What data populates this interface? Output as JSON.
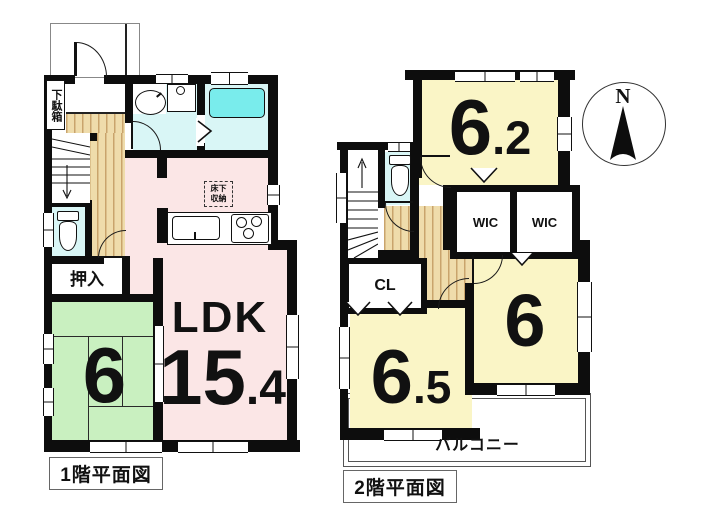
{
  "floor1": {
    "title": "1階平面図",
    "labels": {
      "shoe_cabinet": "下駄箱",
      "underfloor_storage_line1": "床下",
      "underfloor_storage_line2": "収納",
      "oshiire": "押入",
      "tatami_size": "6",
      "ldk": "LDK",
      "ldk_size_whole": "15",
      "ldk_size_fraction": ".4"
    }
  },
  "floor2": {
    "title": "2階平面図",
    "labels": {
      "room_ne_whole": "6",
      "room_ne_fraction": ".2",
      "wic_1": "WIC",
      "wic_2": "WIC",
      "cl": "CL",
      "room_se": "6",
      "room_sw_whole": "6",
      "room_sw_fraction": ".5",
      "balcony": "バルコニー"
    }
  },
  "compass": {
    "north_label": "N"
  },
  "colors": {
    "wall": "#0d0d0d",
    "ldk_pink": "#fbe6e6",
    "tatami_green": "#c9f0c0",
    "wet_area_cyan": "#d9f6f6",
    "bathtub_cyan": "#79ecec",
    "room_yellow": "#faf5c6",
    "wood_floor": "#efdcab"
  }
}
